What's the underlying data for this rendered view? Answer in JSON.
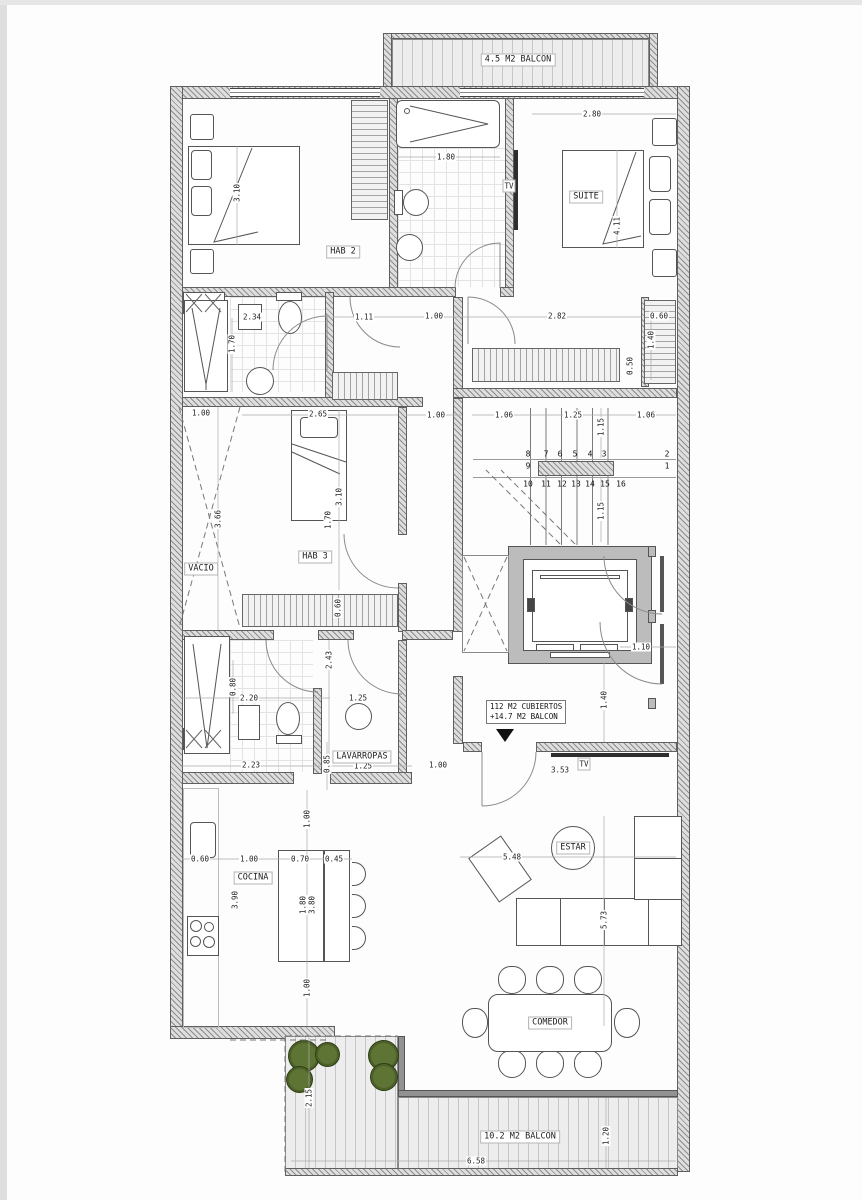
{
  "plan": {
    "rooms": {
      "hab2": "HAB 2",
      "suite": "SUITE",
      "hab3": "HAB 3",
      "vacio": "VACIO",
      "lavarropas": "LAVARROPAS",
      "cocina": "COCINA",
      "estar": "ESTAR",
      "comedor": "COMEDOR"
    },
    "balconies": {
      "top": "4.5 M2 BALCON",
      "bottom": "10.2 M2 BALCON"
    },
    "area_note": {
      "line1": "112 M2 CUBIERTOS",
      "line2": "+14.7 M2 BALCON"
    },
    "tv": {
      "bath_wall": "TV",
      "living_wall": "TV"
    },
    "stair_steps": [
      {
        "n": "1",
        "x": 667,
        "y": 466
      },
      {
        "n": "2",
        "x": 667,
        "y": 454
      },
      {
        "n": "3",
        "x": 604,
        "y": 454
      },
      {
        "n": "4",
        "x": 590,
        "y": 454
      },
      {
        "n": "5",
        "x": 575,
        "y": 454
      },
      {
        "n": "6",
        "x": 560,
        "y": 454
      },
      {
        "n": "7",
        "x": 546,
        "y": 454
      },
      {
        "n": "8",
        "x": 528,
        "y": 454
      },
      {
        "n": "9",
        "x": 528,
        "y": 466
      },
      {
        "n": "10",
        "x": 528,
        "y": 484
      },
      {
        "n": "11",
        "x": 546,
        "y": 484
      },
      {
        "n": "12",
        "x": 562,
        "y": 484
      },
      {
        "n": "13",
        "x": 576,
        "y": 484
      },
      {
        "n": "14",
        "x": 590,
        "y": 484
      },
      {
        "n": "15",
        "x": 605,
        "y": 484
      },
      {
        "n": "16",
        "x": 621,
        "y": 484
      }
    ],
    "dimensions": [
      {
        "t": "2.80",
        "x": 592,
        "y": 114
      },
      {
        "t": "3.10",
        "x": 237,
        "y": 193,
        "v": 1
      },
      {
        "t": "1.80",
        "x": 446,
        "y": 157
      },
      {
        "t": "4.11",
        "x": 617,
        "y": 226,
        "v": 1
      },
      {
        "t": "2.34",
        "x": 252,
        "y": 317
      },
      {
        "t": "1.70",
        "x": 232,
        "y": 344,
        "v": 1
      },
      {
        "t": "1.11",
        "x": 364,
        "y": 317
      },
      {
        "t": "1.00",
        "x": 434,
        "y": 316
      },
      {
        "t": "2.82",
        "x": 557,
        "y": 316
      },
      {
        "t": "0.60",
        "x": 659,
        "y": 316
      },
      {
        "t": "1.40",
        "x": 651,
        "y": 340,
        "v": 1
      },
      {
        "t": "0.50",
        "x": 630,
        "y": 366,
        "v": 1
      },
      {
        "t": "1.06",
        "x": 504,
        "y": 415
      },
      {
        "t": "1.25",
        "x": 573,
        "y": 415
      },
      {
        "t": "1.06",
        "x": 646,
        "y": 415
      },
      {
        "t": "1.15",
        "x": 601,
        "y": 427,
        "v": 1
      },
      {
        "t": "1.15",
        "x": 601,
        "y": 511,
        "v": 1
      },
      {
        "t": "1.00",
        "x": 201,
        "y": 413
      },
      {
        "t": "3.66",
        "x": 218,
        "y": 519,
        "v": 1
      },
      {
        "t": "2.65",
        "x": 318,
        "y": 414
      },
      {
        "t": "1.00",
        "x": 436,
        "y": 415
      },
      {
        "t": "3.10",
        "x": 339,
        "y": 497,
        "v": 1
      },
      {
        "t": "1.70",
        "x": 328,
        "y": 520,
        "v": 1
      },
      {
        "t": "0.60",
        "x": 338,
        "y": 608,
        "v": 1
      },
      {
        "t": "1.10",
        "x": 641,
        "y": 647
      },
      {
        "t": "1.40",
        "x": 604,
        "y": 700,
        "v": 1
      },
      {
        "t": "2.43",
        "x": 329,
        "y": 660,
        "v": 1
      },
      {
        "t": "0.80",
        "x": 233,
        "y": 687,
        "v": 1
      },
      {
        "t": "2.20",
        "x": 249,
        "y": 698
      },
      {
        "t": "1.25",
        "x": 358,
        "y": 698
      },
      {
        "t": "0.85",
        "x": 327,
        "y": 764,
        "v": 1
      },
      {
        "t": "1.25",
        "x": 363,
        "y": 766
      },
      {
        "t": "2.23",
        "x": 251,
        "y": 765
      },
      {
        "t": "1.00",
        "x": 438,
        "y": 765
      },
      {
        "t": "3.53",
        "x": 560,
        "y": 770
      },
      {
        "t": "0.60",
        "x": 200,
        "y": 859
      },
      {
        "t": "1.00",
        "x": 249,
        "y": 859
      },
      {
        "t": "0.70",
        "x": 300,
        "y": 859
      },
      {
        "t": "0.45",
        "x": 334,
        "y": 859
      },
      {
        "t": "1.00",
        "x": 307,
        "y": 819,
        "v": 1
      },
      {
        "t": "3.90",
        "x": 235,
        "y": 900,
        "v": 1
      },
      {
        "t": "1.80",
        "x": 303,
        "y": 905,
        "v": 1
      },
      {
        "t": "3.80",
        "x": 312,
        "y": 905,
        "v": 1
      },
      {
        "t": "1.00",
        "x": 307,
        "y": 988,
        "v": 1
      },
      {
        "t": "5.48",
        "x": 512,
        "y": 857
      },
      {
        "t": "5.73",
        "x": 604,
        "y": 920,
        "v": 1
      },
      {
        "t": "6.58",
        "x": 476,
        "y": 1161
      },
      {
        "t": "2.15",
        "x": 309,
        "y": 1098,
        "v": 1
      },
      {
        "t": "1.20",
        "x": 606,
        "y": 1136,
        "v": 1
      }
    ]
  }
}
